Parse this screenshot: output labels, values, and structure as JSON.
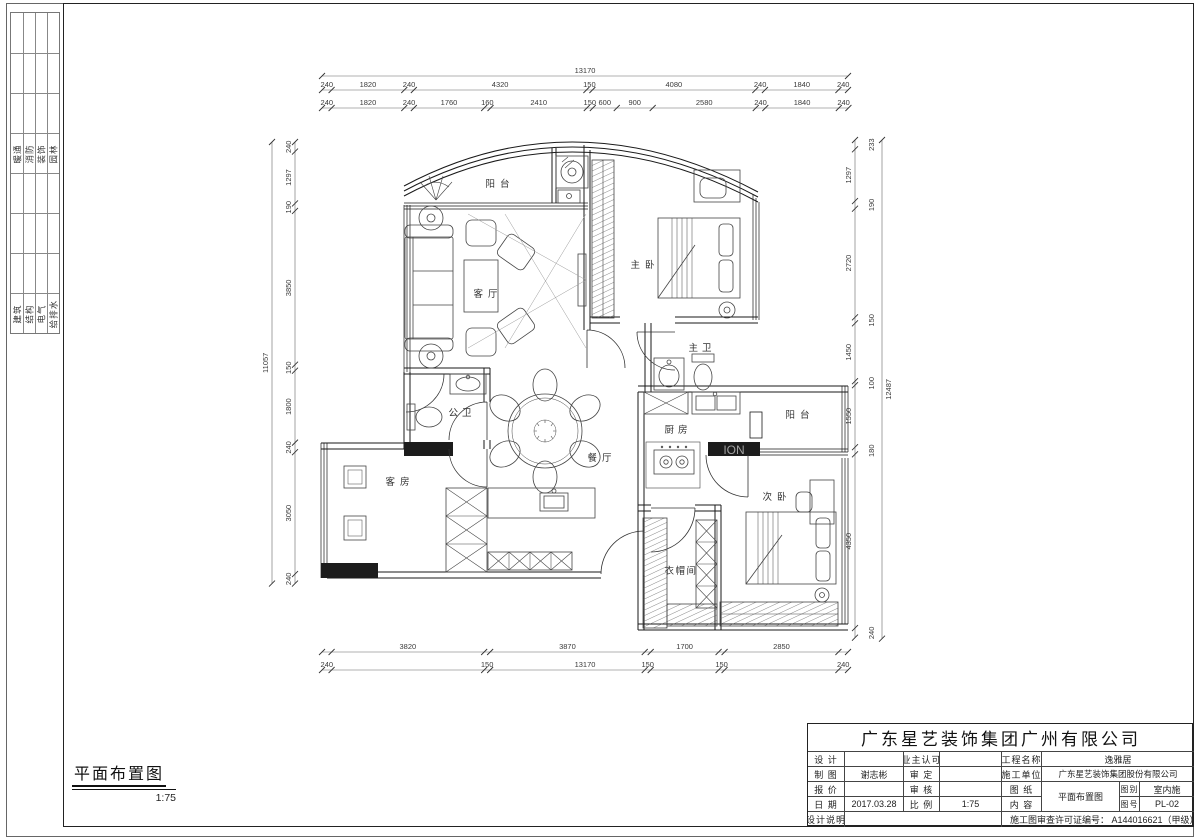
{
  "sheet": {
    "disciplines_top": [
      "暖通",
      "消防",
      "装饰",
      "园林"
    ],
    "disciplines_bottom": [
      "建筑",
      "结构",
      "电气",
      "给排水"
    ],
    "view": {
      "title": "平面布置图",
      "scale": "1:75"
    },
    "watermark": "ION"
  },
  "rooms": {
    "balcony_top": "阳台",
    "living": "客厅",
    "master_bedroom": "主卧",
    "master_bath": "主卫",
    "guest_bath": "公卫",
    "dining": "餐厅",
    "kitchen": "厨房",
    "balcony_right": "阳台",
    "guest_room": "客房",
    "second_bedroom": "次卧",
    "cloakroom": "衣帽间"
  },
  "dims": {
    "top_total": "13170",
    "top_row2": [
      "240",
      "1820",
      "240",
      "4320",
      "150",
      "4080",
      "240",
      "1840",
      "240"
    ],
    "top_row3": [
      "240",
      "1820",
      "240",
      "1760",
      "160",
      "2410",
      "150",
      "600",
      "900",
      "2580",
      "240",
      "1840",
      "240"
    ],
    "left_total": "11057",
    "left_chain": [
      "240",
      "1297",
      "190",
      "3850",
      "150",
      "1800",
      "240",
      "3050",
      "240"
    ],
    "right_total": "12487",
    "right_chain": [
      "233",
      "1297",
      "190",
      "2720",
      "150",
      "1450",
      "100",
      "1550",
      "180",
      "4350",
      "240"
    ],
    "bottom_total": "13170",
    "bottom_chain": [
      "240",
      "3820",
      "150",
      "3870",
      "150",
      "1700",
      "150",
      "2850",
      "240"
    ]
  },
  "title_block": {
    "company": "广东星艺装饰集团广州有限公司",
    "design_label": "设 计",
    "design_value": "",
    "owner_label": "业主认可",
    "owner_value": "",
    "project_label": "工程名称",
    "project_value": "逸雅居",
    "draft_label": "制 图",
    "draft_value": "谢志彬",
    "approve_label": "审 定",
    "approve_value": "",
    "builder_label": "施工单位",
    "builder_value": "广东星艺装饰集团股份有限公司",
    "quote_label": "报 价",
    "quote_value": "",
    "review_label": "审 核",
    "review_value": "",
    "sheet_label": "图 纸",
    "content_label": "内 容",
    "drawing_value": "平面布置图",
    "category_label": "图别",
    "category_value": "室内施",
    "number_label": "图号",
    "number_value": "PL-02",
    "date_label": "日 期",
    "date_value": "2017.03.28",
    "scale_label": "比 例",
    "scale_value": "1:75",
    "notes_label": "设计说明",
    "permit": "施工图审查许可证编号： A144016621（甲级）"
  }
}
